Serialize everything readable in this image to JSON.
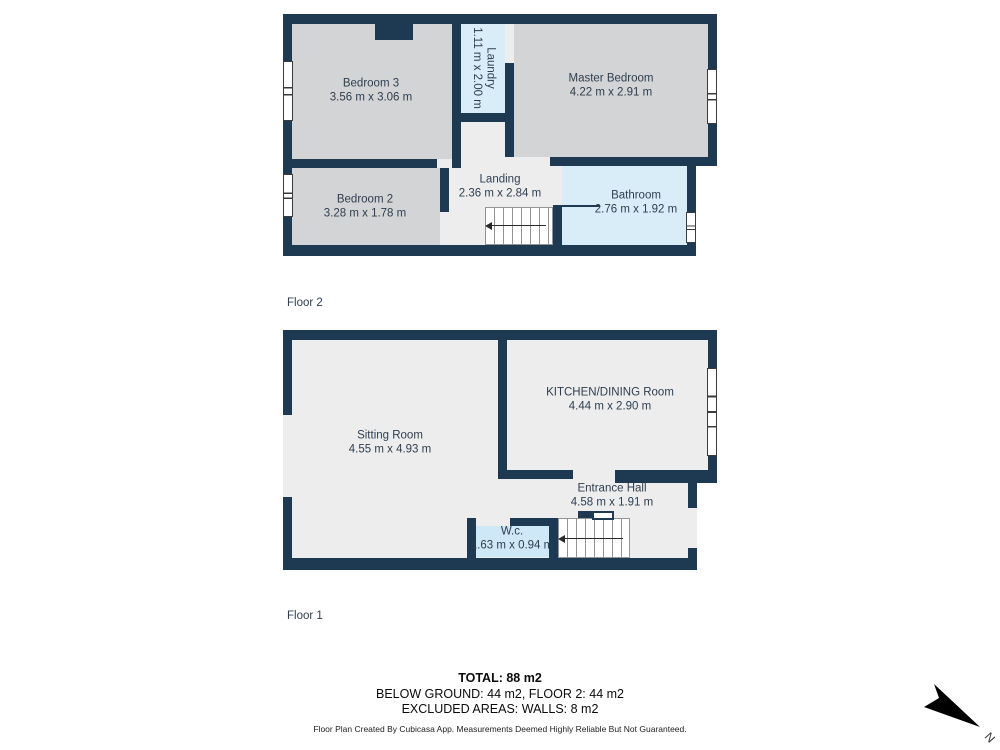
{
  "floor2": {
    "label": "Floor 2",
    "bedroom3": {
      "name": "Bedroom 3",
      "dims": "3.56 m x 3.06 m"
    },
    "laundry": {
      "name": "Laundry",
      "dims": "1.11 m x 2.00 m"
    },
    "master": {
      "name": "Master Bedroom",
      "dims": "4.22 m x 2.91 m"
    },
    "bedroom2": {
      "name": "Bedroom 2",
      "dims": "3.28 m x 1.78 m"
    },
    "landing": {
      "name": "Landing",
      "dims": "2.36 m x 2.84 m"
    },
    "bathroom": {
      "name": "Bathroom",
      "dims": "2.76 m x 1.92 m"
    }
  },
  "floor1": {
    "label": "Floor 1",
    "sitting": {
      "name": "Sitting Room",
      "dims": "4.55 m x 4.93 m"
    },
    "kitchen": {
      "name": "KITCHEN/DINING Room",
      "dims": "4.44 m x 2.90 m"
    },
    "entrance": {
      "name": "Entrance Hall",
      "dims": "4.58 m x 1.91 m"
    },
    "wc": {
      "name": "W.c.",
      "dims": "1.63 m x 0.94 m"
    }
  },
  "summary": {
    "total": "TOTAL: 88 m2",
    "breakdown": "BELOW GROUND: 44 m2, FLOOR 2: 44 m2",
    "excluded": "EXCLUDED AREAS: WALLS: 8 m2"
  },
  "disclaimer": "Floor Plan Created By Cubicasa App. Measurements Deemed Highly Reliable But Not Guaranteed.",
  "compass": {
    "label": "N"
  },
  "colors": {
    "wall": "#1d3a52",
    "room_gray": "#d3d4d5",
    "room_light_gray": "#ededee",
    "room_blue": "#d9edf8",
    "wc_blue": "#cfe8f7",
    "label_text": "#2e3e50"
  }
}
